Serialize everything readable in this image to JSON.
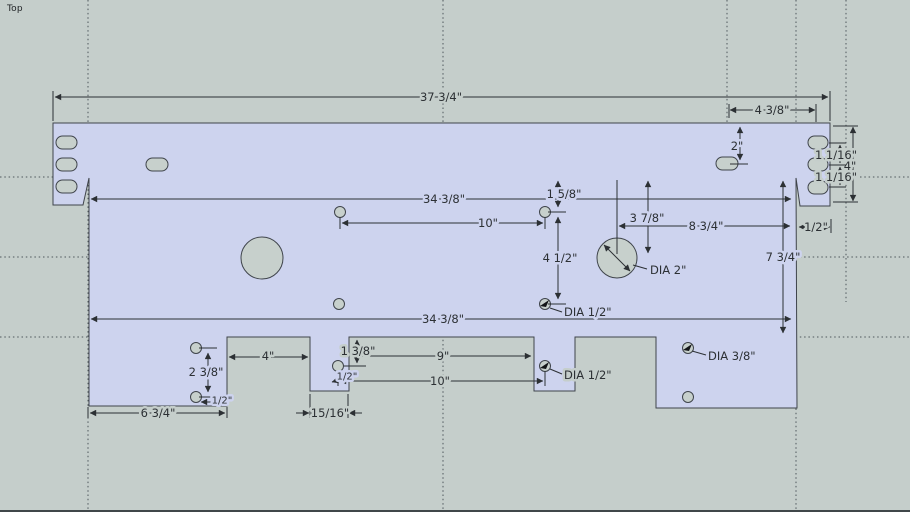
{
  "view": {
    "label": "Top"
  },
  "colors": {
    "background": "#c5cecb",
    "part": "#cdd3ee",
    "hole": "#c7d0cc",
    "edge": "#3f444b",
    "dim": "#2c3034",
    "guide": "#4d555b",
    "bottom": "#40474a"
  },
  "dims": {
    "overall_width": "37 3/4\"",
    "flange_slot_offset": "4 3/8\"",
    "slot_from_top": "2\"",
    "right_slot_pitch_top": "1 1/16\"",
    "right_flange_height": "4\"",
    "right_slot_pitch_bottom": "1 1/16\"",
    "right_step": "1/2\"",
    "body_width_top": "34 3/8\"",
    "top_hole_spacing": "10\"",
    "hole_offset_top": "1 5/8\"",
    "hole_pitch_vertical": "4 1/2\"",
    "circle_offset_top": "3 7/8\"",
    "circle_from_right": "8 3/4\"",
    "body_height": "7 3/4\"",
    "body_width_bottom": "34 3/8\"",
    "notch_width_left": "4\"",
    "tab_hole_offset": "1 3/8\"",
    "notch_width_mid": "9\"",
    "bottom_hole_spacing": "10\"",
    "tab_hole_inset": "1/2\"",
    "left_tab_hole_pitch": "2 3/8\"",
    "left_tab_hole_edge": "1/2\"",
    "left_tab_width": "6 3/4\"",
    "small_tab_width": "15/16\""
  },
  "callouts": {
    "dia_circle": "DIA 2\"",
    "dia_hole_upper": "DIA 1/2\"",
    "dia_hole_lower": "DIA 1/2\"",
    "dia_hole_tab": "DIA 3/8\""
  }
}
